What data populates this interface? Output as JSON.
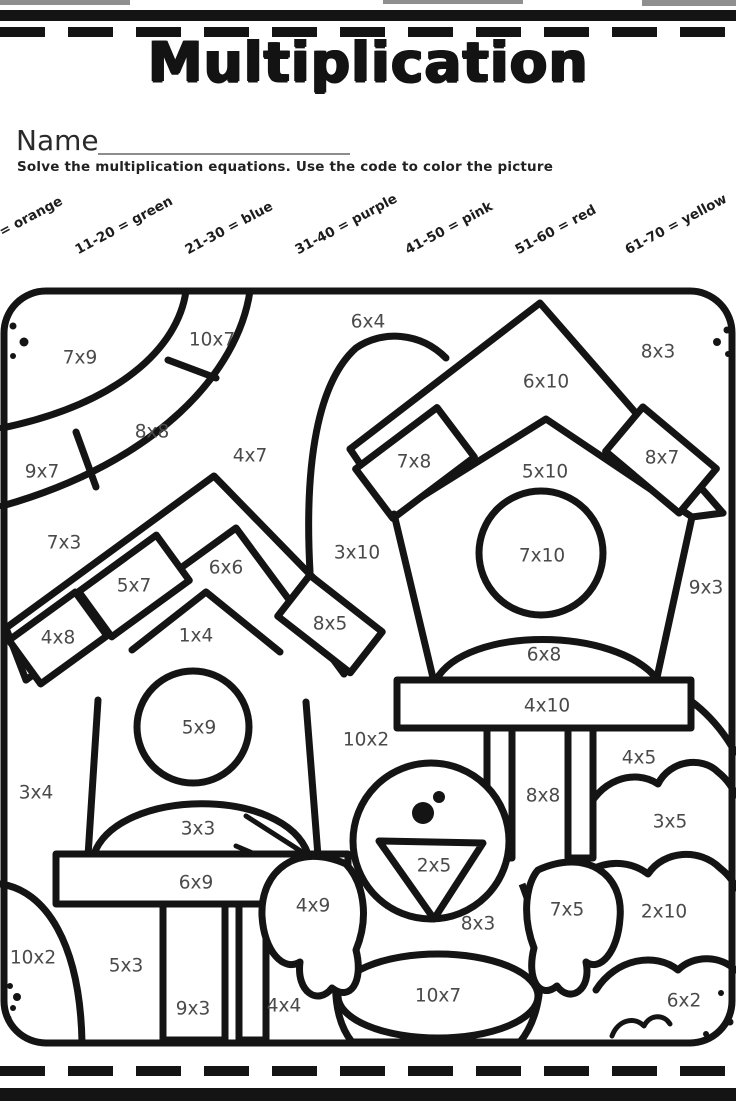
{
  "page": {
    "title": "Multiplication",
    "name_label": "Name",
    "instructions": "Solve the multiplication equations.  Use the code to color the picture"
  },
  "color_code": [
    {
      "label": "1-10 = orange"
    },
    {
      "label": "11-20 = green"
    },
    {
      "label": "21-30 = blue"
    },
    {
      "label": "31-40 = purple"
    },
    {
      "label": "41-50 = pink"
    },
    {
      "label": "51-60 = red"
    },
    {
      "label": "61-70 = yellow"
    }
  ],
  "colors": {
    "ink": "#141414",
    "equation_text": "#4a4a4a"
  },
  "picture": {
    "equations": [
      {
        "text": "7x9",
        "x": 80,
        "y": 358
      },
      {
        "text": "10x7",
        "x": 212,
        "y": 340
      },
      {
        "text": "6x4",
        "x": 368,
        "y": 322
      },
      {
        "text": "8x3",
        "x": 658,
        "y": 352
      },
      {
        "text": "6x10",
        "x": 546,
        "y": 382
      },
      {
        "text": "8x8",
        "x": 152,
        "y": 432
      },
      {
        "text": "4x7",
        "x": 250,
        "y": 456
      },
      {
        "text": "7x8",
        "x": 414,
        "y": 462
      },
      {
        "text": "8x7",
        "x": 662,
        "y": 458
      },
      {
        "text": "9x7",
        "x": 42,
        "y": 472
      },
      {
        "text": "5x10",
        "x": 545,
        "y": 472
      },
      {
        "text": "7x3",
        "x": 64,
        "y": 543
      },
      {
        "text": "3x10",
        "x": 357,
        "y": 553
      },
      {
        "text": "7x10",
        "x": 542,
        "y": 556
      },
      {
        "text": "6x6",
        "x": 226,
        "y": 568
      },
      {
        "text": "9x3",
        "x": 706,
        "y": 588
      },
      {
        "text": "5x7",
        "x": 134,
        "y": 586
      },
      {
        "text": "8x5",
        "x": 330,
        "y": 624
      },
      {
        "text": "4x8",
        "x": 58,
        "y": 638
      },
      {
        "text": "1x4",
        "x": 196,
        "y": 636
      },
      {
        "text": "6x8",
        "x": 544,
        "y": 655
      },
      {
        "text": "5x9",
        "x": 199,
        "y": 728
      },
      {
        "text": "10x2",
        "x": 366,
        "y": 740
      },
      {
        "text": "4x10",
        "x": 547,
        "y": 706
      },
      {
        "text": "3x4",
        "x": 36,
        "y": 793
      },
      {
        "text": "4x5",
        "x": 639,
        "y": 758
      },
      {
        "text": "8x8",
        "x": 543,
        "y": 796
      },
      {
        "text": "3x3",
        "x": 198,
        "y": 829
      },
      {
        "text": "3x5",
        "x": 670,
        "y": 822
      },
      {
        "text": "2x5",
        "x": 434,
        "y": 866
      },
      {
        "text": "6x9",
        "x": 196,
        "y": 883
      },
      {
        "text": "4x9",
        "x": 313,
        "y": 906
      },
      {
        "text": "7x5",
        "x": 567,
        "y": 910
      },
      {
        "text": "2x10",
        "x": 664,
        "y": 912
      },
      {
        "text": "8x3",
        "x": 478,
        "y": 924
      },
      {
        "text": "10x2",
        "x": 33,
        "y": 958
      },
      {
        "text": "5x3",
        "x": 126,
        "y": 966
      },
      {
        "text": "9x3",
        "x": 193,
        "y": 1009
      },
      {
        "text": "4x4",
        "x": 284,
        "y": 1006
      },
      {
        "text": "10x7",
        "x": 438,
        "y": 996
      },
      {
        "text": "6x2",
        "x": 684,
        "y": 1001
      }
    ]
  }
}
